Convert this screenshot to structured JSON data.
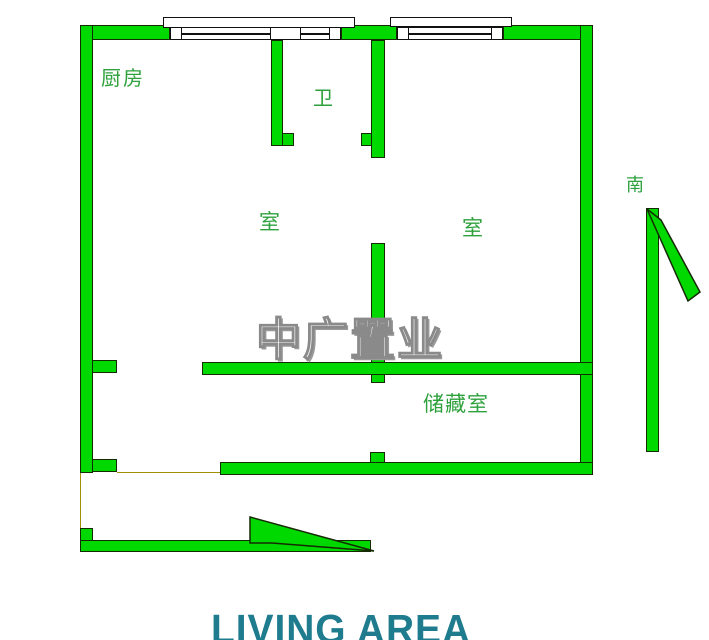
{
  "colors": {
    "wall_fill": "#00d900",
    "wall_outline": "#152a00",
    "label_green": "#2ea13c",
    "watermark_gray": "#8a8a8a",
    "living_teal": "#1e7c8e",
    "line_olive": "#a08f00"
  },
  "labels": {
    "kitchen": "厨房",
    "bathroom": "卫",
    "room_left": "室",
    "room_right": "室",
    "storage": "储藏室",
    "south": "南"
  },
  "watermark": {
    "text": "中广置业"
  },
  "caption": {
    "text": "LIVING AREA"
  }
}
